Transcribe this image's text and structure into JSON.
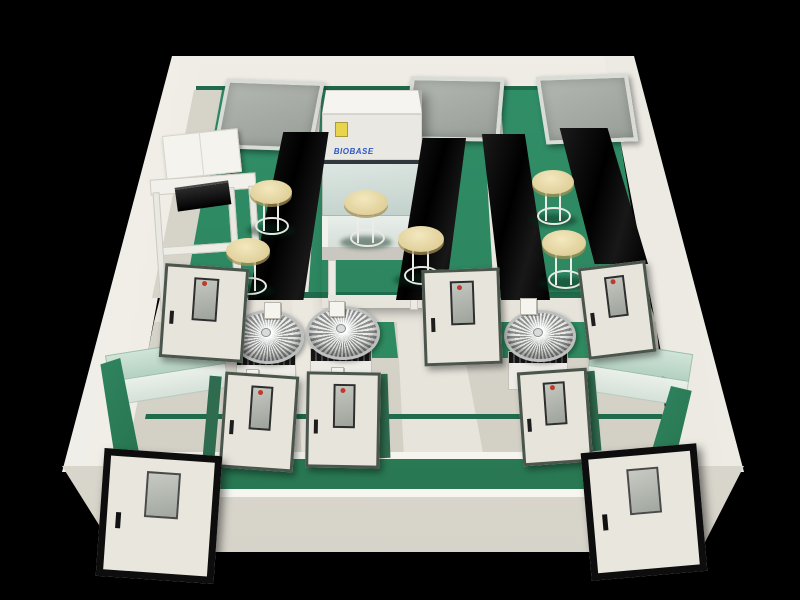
{
  "scene": {
    "description": "3D cutaway render of a laboratory suite with green floors, cream walls, black lab benches, stools, biosafety cabinet, fan units and doors",
    "cabinet_brand": "BIOBASE",
    "palette": {
      "background": "#000000",
      "floor_green": "#2E8A60",
      "corridor_green": "#2F8963",
      "wall_cream": "#EAE8E0",
      "wall_shadow": "#D0CDC3",
      "bench_black": "#0B0B0B",
      "stool_beige": "#E8DBA9",
      "counter_mint": "#BEDACB",
      "window_gray": "#A6AAA4",
      "door_face": "#E7E4DB",
      "door_frame_dark": "#0D0D0D",
      "door_frame_green": "#4A554C",
      "brand_blue": "#2B57C8",
      "sticker_yellow": "#E8D44D",
      "metal_silver": "#C9CCCB",
      "vision_dot_red": "#C03A2B"
    },
    "items": [
      {
        "type": "window",
        "name": "back-wall-window-left",
        "x": 220,
        "y": 80,
        "w": 90,
        "h": 62,
        "rot": 2,
        "skew": -9
      },
      {
        "type": "window",
        "name": "back-wall-window-center",
        "x": 408,
        "y": 77,
        "w": 86,
        "h": 56,
        "rot": 1,
        "skew": -4
      },
      {
        "type": "window",
        "name": "back-wall-window-right",
        "x": 541,
        "y": 75,
        "w": 84,
        "h": 60,
        "rot": -2,
        "skew": 7
      },
      {
        "type": "wallcab",
        "name": "wall-cabinet",
        "x": 164,
        "y": 132,
        "w": 74,
        "h": 42,
        "rot": -6
      },
      {
        "type": "table",
        "name": "prep-table",
        "x": 154,
        "y": 176,
        "w": 104,
        "h": 130,
        "rot": -4
      },
      {
        "type": "instrument",
        "name": "benchtop-instrument",
        "x": 176,
        "y": 184,
        "w": 54,
        "h": 22,
        "rot": -8
      },
      {
        "type": "bsc",
        "name": "biosafety-cabinet",
        "x": 322,
        "y": 90,
        "w": 100,
        "h": 218
      },
      {
        "type": "bench",
        "name": "lab-bench-1",
        "x": 248,
        "y": 132,
        "w": 84,
        "h": 168,
        "clip": "42% 0,96% 0,66% 100%,0 100%"
      },
      {
        "type": "bench",
        "name": "lab-bench-2",
        "x": 396,
        "y": 138,
        "w": 70,
        "h": 162,
        "clip": "38% 0,100% 0,70% 100%,0 100%"
      },
      {
        "type": "bench",
        "name": "lab-bench-3",
        "x": 476,
        "y": 134,
        "w": 74,
        "h": 166,
        "clip": "8% 0,66% 0,100% 100%,34% 100%"
      },
      {
        "type": "bench",
        "name": "lab-bench-4",
        "x": 556,
        "y": 128,
        "w": 92,
        "h": 136,
        "clip": "4% 0,56% 0,100% 100%,42% 100%"
      },
      {
        "type": "stool",
        "name": "lab-stool-1",
        "x": 250,
        "y": 180,
        "w": 42,
        "h": 58
      },
      {
        "type": "stool",
        "name": "lab-stool-2",
        "x": 226,
        "y": 238,
        "w": 44,
        "h": 60
      },
      {
        "type": "stool",
        "name": "lab-stool-3",
        "x": 344,
        "y": 190,
        "w": 44,
        "h": 60
      },
      {
        "type": "stool",
        "name": "lab-stool-4",
        "x": 398,
        "y": 226,
        "w": 46,
        "h": 62
      },
      {
        "type": "stool",
        "name": "lab-stool-5",
        "x": 532,
        "y": 170,
        "w": 42,
        "h": 58
      },
      {
        "type": "stool",
        "name": "lab-stool-6",
        "x": 542,
        "y": 230,
        "w": 44,
        "h": 62
      },
      {
        "type": "fan",
        "name": "fan-unit-1",
        "x": 232,
        "y": 310,
        "w": 66,
        "h": 82
      },
      {
        "type": "fan",
        "name": "fan-unit-2",
        "x": 306,
        "y": 306,
        "w": 68,
        "h": 82
      },
      {
        "type": "fan",
        "name": "fan-unit-3",
        "x": 504,
        "y": 310,
        "w": 66,
        "h": 80
      },
      {
        "type": "switch",
        "name": "wall-switch-1",
        "x": 264,
        "y": 302,
        "w": 15,
        "h": 15
      },
      {
        "type": "switch",
        "name": "wall-switch-2",
        "x": 329,
        "y": 301,
        "w": 14,
        "h": 14
      },
      {
        "type": "switch",
        "name": "wall-switch-3",
        "x": 520,
        "y": 298,
        "w": 15,
        "h": 15
      },
      {
        "type": "switch",
        "name": "wall-switch-4",
        "x": 246,
        "y": 369,
        "w": 11,
        "h": 11
      },
      {
        "type": "switch",
        "name": "wall-switch-5",
        "x": 331,
        "y": 367,
        "w": 11,
        "h": 11
      },
      {
        "type": "counter",
        "name": "side-counter-left",
        "x": 108,
        "y": 346,
        "w": 118,
        "h": 48,
        "rot": -9
      },
      {
        "type": "counter",
        "name": "side-counter-right",
        "x": 588,
        "y": 346,
        "w": 102,
        "h": 50,
        "rot": 9
      },
      {
        "type": "greenstrip",
        "name": "floor-strip-left",
        "x": 96,
        "y": 358,
        "w": 44,
        "h": 106,
        "clip": "10% 6%,55% 0,100% 94%,45% 100%"
      },
      {
        "type": "greenstrip",
        "name": "floor-strip-right",
        "x": 648,
        "y": 386,
        "w": 46,
        "h": 82,
        "clip": "50% 0,95% 6%,55% 100%,0 94%"
      },
      {
        "type": "greencap",
        "name": "wall-cap-1",
        "x": 206,
        "y": 376,
        "w": 12,
        "h": 86,
        "rot": 5
      },
      {
        "type": "greencap",
        "name": "wall-cap-2",
        "x": 378,
        "y": 374,
        "w": 11,
        "h": 84,
        "rot": -2
      },
      {
        "type": "greencap",
        "name": "wall-cap-3",
        "x": 589,
        "y": 371,
        "w": 9,
        "h": 80,
        "rot": -5
      },
      {
        "type": "door",
        "name": "interior-door-1",
        "x": 162,
        "y": 266,
        "w": 78,
        "h": 88,
        "rot": 4
      },
      {
        "type": "door",
        "name": "interior-door-2",
        "x": 423,
        "y": 269,
        "w": 72,
        "h": 90,
        "rot": -2
      },
      {
        "type": "door",
        "name": "interior-door-3",
        "x": 583,
        "y": 264,
        "w": 62,
        "h": 86,
        "rot": -7
      },
      {
        "type": "door",
        "name": "interior-door-4",
        "x": 222,
        "y": 374,
        "w": 68,
        "h": 90,
        "rot": 4
      },
      {
        "type": "door",
        "name": "interior-door-5",
        "x": 306,
        "y": 372,
        "w": 68,
        "h": 90,
        "rot": 1
      },
      {
        "type": "door",
        "name": "interior-door-6",
        "x": 520,
        "y": 370,
        "w": 64,
        "h": 88,
        "rot": -4
      },
      {
        "type": "door-entry",
        "name": "entry-door-left",
        "x": 100,
        "y": 452,
        "w": 104,
        "h": 114,
        "rot": 4,
        "z": 60
      },
      {
        "type": "door-entry",
        "name": "entry-door-right",
        "x": 586,
        "y": 448,
        "w": 102,
        "h": 114,
        "rot": -5,
        "z": 60
      }
    ]
  }
}
